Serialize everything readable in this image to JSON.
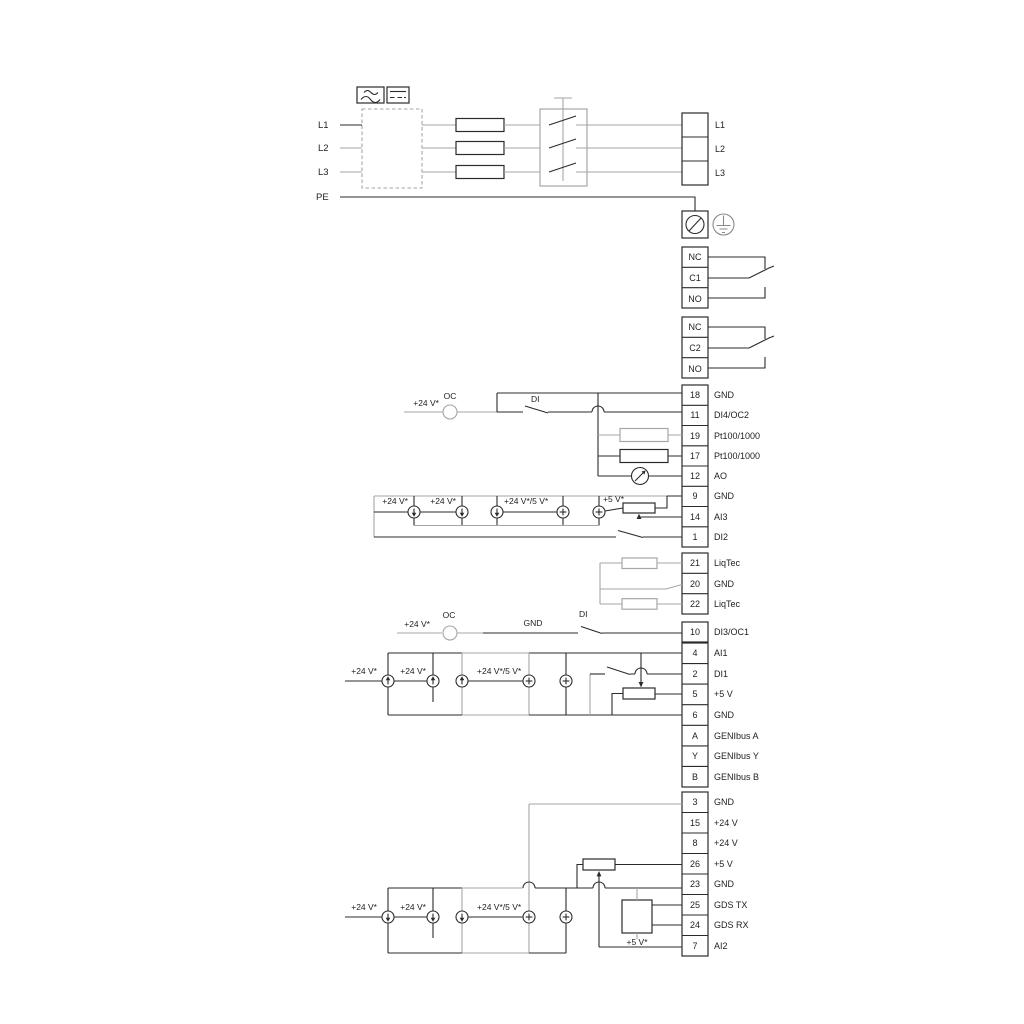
{
  "diagram_type": "pump-drive-wiring-diagram",
  "colors": {
    "wire_dark": "#2b2b2b",
    "wire_gray": "#a6a6a6",
    "text": "#222222",
    "background": "#ffffff"
  },
  "power_in": {
    "lines": [
      {
        "label": "L1"
      },
      {
        "label": "L2"
      },
      {
        "label": "L3"
      },
      {
        "label": "PE"
      }
    ]
  },
  "power_out": {
    "terminals": [
      {
        "label": "L1"
      },
      {
        "label": "L2"
      },
      {
        "label": "L3"
      }
    ]
  },
  "relay1": {
    "terminals": [
      {
        "label": "NC"
      },
      {
        "label": "C1"
      },
      {
        "label": "NO"
      }
    ]
  },
  "relay2": {
    "terminals": [
      {
        "label": "NC"
      },
      {
        "label": "C2"
      },
      {
        "label": "NO"
      }
    ]
  },
  "strip1": {
    "rows": [
      {
        "no": "18",
        "label": "GND"
      },
      {
        "no": "11",
        "label": "DI4/OC2"
      },
      {
        "no": "19",
        "label": "Pt100/1000"
      },
      {
        "no": "17",
        "label": "Pt100/1000"
      },
      {
        "no": "12",
        "label": "AO"
      },
      {
        "no": "9",
        "label": "GND"
      },
      {
        "no": "14",
        "label": "AI3"
      },
      {
        "no": "1",
        "label": "DI2"
      }
    ]
  },
  "liqtec": {
    "rows": [
      {
        "no": "21",
        "label": "LiqTec"
      },
      {
        "no": "20",
        "label": "GND"
      },
      {
        "no": "22",
        "label": "LiqTec"
      }
    ]
  },
  "di3": {
    "rows": [
      {
        "no": "10",
        "label": "DI3/OC1"
      }
    ]
  },
  "strip2": {
    "rows": [
      {
        "no": "4",
        "label": "AI1"
      },
      {
        "no": "2",
        "label": "DI1"
      },
      {
        "no": "5",
        "label": "+5 V"
      },
      {
        "no": "6",
        "label": "GND"
      },
      {
        "no": "A",
        "label": "GENIbus A"
      },
      {
        "no": "Y",
        "label": "GENIbus Y"
      },
      {
        "no": "B",
        "label": "GENIbus B"
      }
    ]
  },
  "strip3": {
    "rows": [
      {
        "no": "3",
        "label": "GND"
      },
      {
        "no": "15",
        "label": "+24 V"
      },
      {
        "no": "8",
        "label": "+24 V"
      },
      {
        "no": "26",
        "label": "+5 V"
      },
      {
        "no": "23",
        "label": "GND"
      },
      {
        "no": "25",
        "label": "GDS TX"
      },
      {
        "no": "24",
        "label": "GDS RX"
      },
      {
        "no": "7",
        "label": "AI2"
      }
    ]
  },
  "labels": {
    "v24": "+24 V*",
    "v24_5": "+24 V*/5 V*",
    "v5": "+5 V*",
    "oc": "OC",
    "di": "DI",
    "gnd": "GND"
  }
}
